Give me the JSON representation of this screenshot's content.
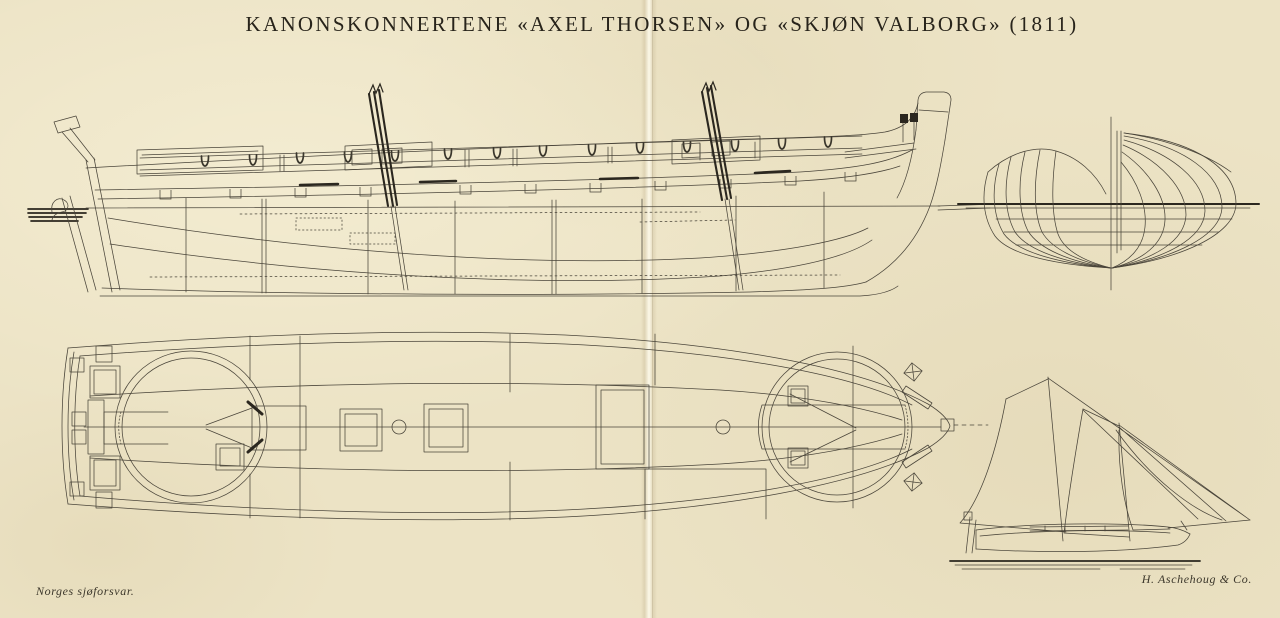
{
  "page": {
    "title": "KANONSKONNERTENE «AXEL THORSEN» OG «SKJØN VALBORG» (1811)",
    "credit_left": "Norges sjøforsvar.",
    "credit_right": "H. Aschehoug & Co."
  },
  "colors": {
    "paper": "#ece3c5",
    "ink": "#4a453a",
    "ink_dark": "#2b271f"
  }
}
